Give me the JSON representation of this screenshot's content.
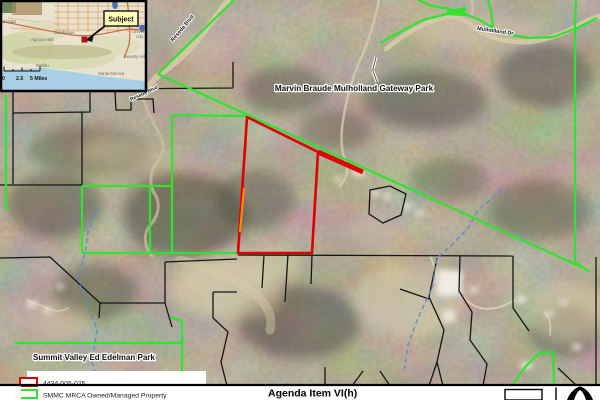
{
  "inset": {
    "callout": "Subject",
    "scale": {
      "zero": "0",
      "mid": "2.5",
      "end": "5 Miles"
    },
    "cities": {
      "thousand_oaks": "Thousand Oaks",
      "calabasas": "Calabasas",
      "agoura_hills": "Agoura Hills",
      "malibu": "Malibu",
      "santa_monica": "Santa Monica",
      "beverly_hills": "Beverly Hills",
      "universal_city_1": "Universal",
      "universal_city_2": "City"
    }
  },
  "map": {
    "park_label_north": "Marvin Braude Mulholland Gateway Park",
    "park_label_south": "Summit Valley Ed Edelman Park",
    "road_label_reseda": "Reseda Blvd",
    "road_label_reseda2": "Reseda Blvd",
    "road_label_mulholland": "Mulholland Dr"
  },
  "legend": {
    "items": [
      {
        "label": "4434-005-025",
        "color": "#dd0000"
      },
      {
        "label": "SMMC MRCA Owned/Managed Property",
        "color": "#2fe32f"
      }
    ]
  },
  "footer": {
    "agenda": "Agenda Item VI(h)"
  },
  "colors": {
    "parcel_red": "#dd0000",
    "parcel_orange": "#ff8800",
    "mrca_green": "#2fe32f",
    "creek_blue": "#5b8ad0"
  }
}
